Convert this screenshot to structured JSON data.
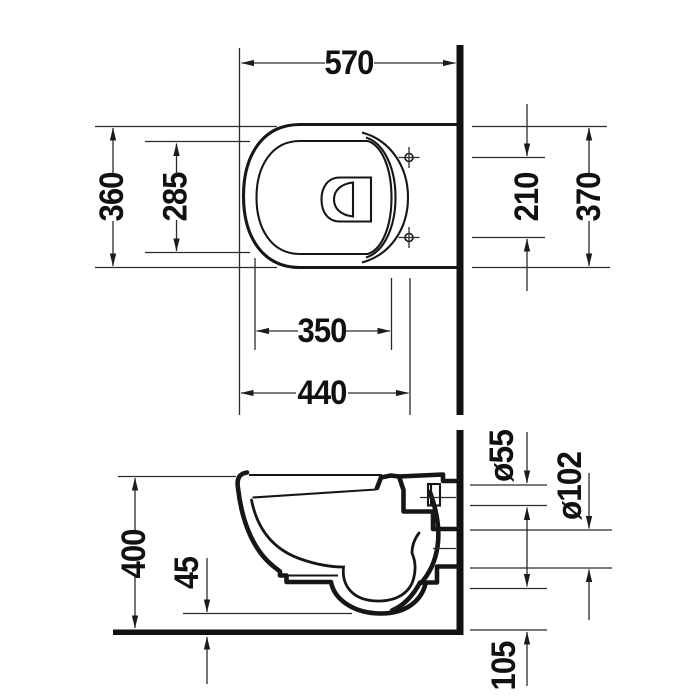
{
  "drawing": {
    "dims": {
      "top_view": {
        "overall_depth": "570",
        "bowl_width": "360",
        "inner_width": "285",
        "hole_spacing": "210",
        "seat_width": "370",
        "inner_depth": "350",
        "hole_depth": "440"
      },
      "side_view": {
        "bowl_height": "400",
        "floor_clearance": "45",
        "supply_pipe_diameter": "ø55",
        "outlet_pipe_diameter": "ø102",
        "outlet_height": "105"
      }
    },
    "colors": {
      "line": "#161616",
      "dimension_line": "#2b2b2b",
      "background": "#ffffff"
    }
  }
}
